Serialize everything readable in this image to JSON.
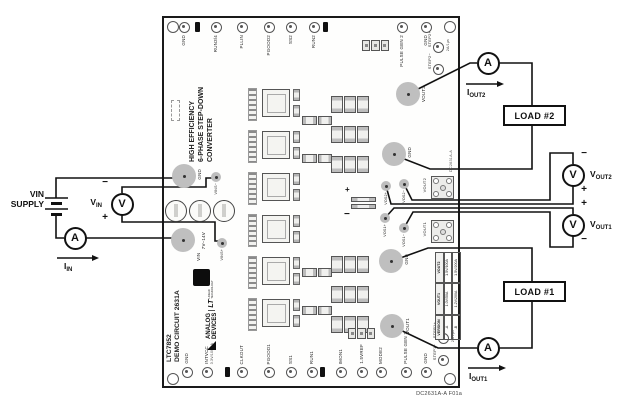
{
  "caption": "DC2631A-A F01a",
  "signs": {
    "plus": "+",
    "minus": "−"
  },
  "meters": {
    "ammeter": "A",
    "voltmeter": "V"
  },
  "external": {
    "vin_supply": {
      "v": "V",
      "v_sub": "IN",
      "line2": "SUPPLY"
    },
    "vin_meter": {
      "m": "V",
      "sub": "IN"
    },
    "iin": {
      "m": "I",
      "sub": "IN"
    },
    "iout2": {
      "m": "I",
      "sub": "OUT2"
    },
    "iout1": {
      "m": "I",
      "sub": "OUT1"
    },
    "vout2_meter": {
      "m": "V",
      "sub": "OUT2"
    },
    "vout1_meter": {
      "m": "V",
      "sub": "OUT1"
    },
    "load2": "LOAD #2",
    "load1": "LOAD #1"
  },
  "board": {
    "title_line1": "HIGH EFFICIENCY",
    "title_line2": "6-PHASE STEP-DOWN",
    "title_line3": "CONVERTER",
    "name_line1": "LTC7852",
    "name_line2": "DEMO CIRCUIT 2631A",
    "logo": {
      "brand1": "ANALOG",
      "brand2": "DEVICES",
      "lt": "LT",
      "lt_sub": "LINEAR TECHNOLOGY"
    },
    "etch_text": "DC2631A-A",
    "mount_holes": [
      {
        "x": 172,
        "y": 26
      },
      {
        "x": 449,
        "y": 26
      },
      {
        "x": 172,
        "y": 378
      },
      {
        "x": 449,
        "y": 378
      }
    ],
    "top_testpoints": [
      {
        "label": "GND",
        "x": 184,
        "y": 27
      },
      {
        "label": "",
        "x": 197,
        "y": 27,
        "cls": "jp"
      },
      {
        "label": "RUN3/4",
        "x": 216,
        "y": 27
      },
      {
        "label": "PLLIN",
        "x": 242,
        "y": 27
      },
      {
        "label": "PGOOD2",
        "x": 269,
        "y": 27
      },
      {
        "label": "SS2",
        "x": 291,
        "y": 27
      },
      {
        "label": "RUN2",
        "x": 314,
        "y": 27
      },
      {
        "label": "",
        "x": 325,
        "y": 27,
        "cls": "jp"
      },
      {
        "label": "PULSE GEN 2",
        "x": 402,
        "y": 27
      },
      {
        "label": "GND",
        "x": 426,
        "y": 27
      }
    ],
    "bottom_testpoints": [
      {
        "label": "GND",
        "x": 187,
        "y": 372
      },
      {
        "label": "INTVCC",
        "sub": "3.3V/100mA",
        "x": 207,
        "y": 372
      },
      {
        "label": "",
        "x": 227,
        "y": 372,
        "cls": "jp"
      },
      {
        "label": "CLKOUT",
        "x": 242,
        "y": 372
      },
      {
        "label": "PGOOD1",
        "x": 269,
        "y": 372
      },
      {
        "label": "SS1",
        "x": 291,
        "y": 372
      },
      {
        "label": "RUN1",
        "x": 312,
        "y": 372
      },
      {
        "label": "",
        "x": 322,
        "y": 372,
        "cls": "jp"
      },
      {
        "label": "IMON1",
        "x": 341,
        "y": 372
      },
      {
        "label": "1.5VREF",
        "x": 362,
        "y": 372
      },
      {
        "label": "MODE2",
        "x": 381,
        "y": 372
      },
      {
        "label": "PULSE GEN 1",
        "x": 406,
        "y": 372
      },
      {
        "label": "GND",
        "x": 426,
        "y": 372
      }
    ],
    "side_testpoints": [
      {
        "label": "STEP2+",
        "sub": "2A/1µs",
        "x": 438,
        "y": 47
      },
      {
        "label": "STEP2−",
        "x": 438,
        "y": 69
      },
      {
        "label": "STEP1+",
        "sub": "2A/1µs",
        "x": 443,
        "y": 338
      },
      {
        "label": "STEP1−",
        "x": 443,
        "y": 360
      }
    ],
    "pads": [
      {
        "label": "GND",
        "x": 184,
        "y": 176
      },
      {
        "label": "VIN",
        "sub": "7V–14V",
        "x": 183,
        "y": 240
      },
      {
        "label": "VOUT2",
        "x": 408,
        "y": 94
      },
      {
        "label": "GND",
        "x": 394,
        "y": 154
      },
      {
        "label": "GND",
        "x": 391,
        "y": 261
      },
      {
        "label": "VOUT1",
        "x": 392,
        "y": 326
      }
    ],
    "sense_pads": [
      {
        "label": "VINS−",
        "x": 216,
        "y": 177
      },
      {
        "label": "VINS+",
        "x": 222,
        "y": 243
      },
      {
        "label": "VOS2+",
        "x": 386,
        "y": 186
      },
      {
        "label": "VOS2−",
        "x": 404,
        "y": 184
      },
      {
        "label": "VOS1+",
        "x": 385,
        "y": 218
      },
      {
        "label": "VOS1−",
        "x": 404,
        "y": 228
      }
    ],
    "connectors": [
      {
        "label": "VOUT2",
        "x": 431,
        "y": 176
      },
      {
        "label": "VOUT1",
        "x": 431,
        "y": 220
      }
    ],
    "stages": [
      {
        "x": 248,
        "y": 86
      },
      {
        "x": 248,
        "y": 128
      },
      {
        "x": 248,
        "y": 170
      },
      {
        "x": 248,
        "y": 212
      },
      {
        "x": 248,
        "y": 254
      },
      {
        "x": 248,
        "y": 296
      }
    ],
    "cap_rows": [
      {
        "x": 331,
        "y": 96
      },
      {
        "x": 331,
        "y": 126
      },
      {
        "x": 331,
        "y": 156
      },
      {
        "x": 331,
        "y": 256
      },
      {
        "x": 331,
        "y": 286
      },
      {
        "x": 331,
        "y": 316
      }
    ],
    "cap_bank_labels": [
      {
        "text": "1.5V/IOUT MAX",
        "x": 372,
        "y": 98
      },
      {
        "text": "1.0V/IOUT MAX",
        "x": 372,
        "y": 256
      }
    ],
    "jumpers2": [
      {
        "x": 302,
        "y": 116
      },
      {
        "x": 302,
        "y": 154
      },
      {
        "x": 302,
        "y": 268
      },
      {
        "x": 302,
        "y": 306
      }
    ],
    "headers3": [
      {
        "x": 362,
        "y": 40
      },
      {
        "x": 348,
        "y": 328
      }
    ],
    "ecaps": [
      {
        "x": 165,
        "y": 200
      },
      {
        "x": 189,
        "y": 200
      },
      {
        "x": 213,
        "y": 200
      }
    ],
    "version_table": {
      "headers": [
        "VERSION",
        "VOUT1",
        "VOUT2"
      ],
      "rows": [
        [
          "-A",
          "1.0V/50A",
          "1.5V/100A"
        ],
        [
          "-B",
          "1.2V/200A",
          "1.5V/200A"
        ]
      ]
    }
  }
}
